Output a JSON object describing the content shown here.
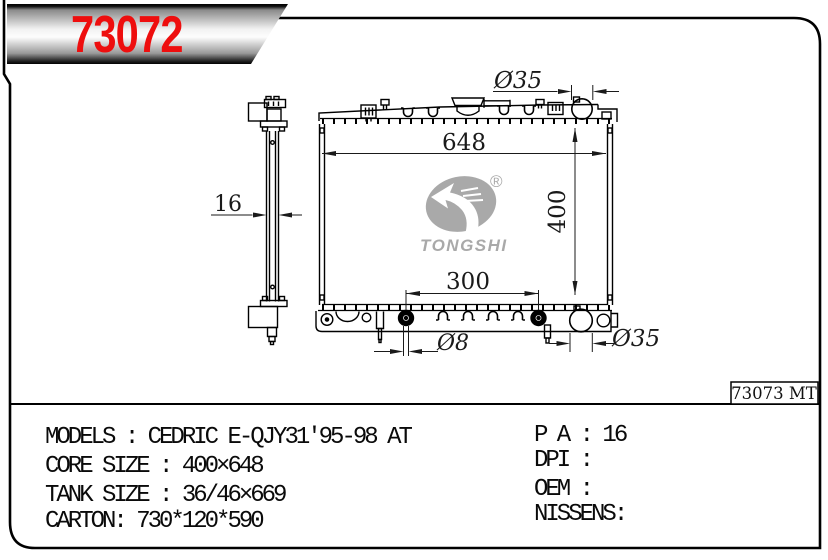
{
  "page": {
    "part_number": "73072",
    "stamp_code": "73073 MT"
  },
  "watermark": {
    "brand": "TONGSHI",
    "registered": "®"
  },
  "drawing": {
    "dim_core_width": "648",
    "dim_core_height": "400",
    "dim_pin_spacing": "300",
    "dim_pin_dia": "Ø8",
    "dim_inlet_dia": "Ø35",
    "dim_outlet_dia": "Ø35",
    "dim_thickness": "16"
  },
  "specs": {
    "models": "MODELS : CEDRIC E-QJY31'95-98 AT",
    "core_size": "CORE SIZE : 400×648",
    "tank_size": "TANK SIZE : 36/46×669",
    "carton": "CARTON: 730*120*590",
    "pa": "P A : 16",
    "dpi": "DPI :",
    "oem": "OEM :",
    "nissens": "NISSENS:"
  }
}
